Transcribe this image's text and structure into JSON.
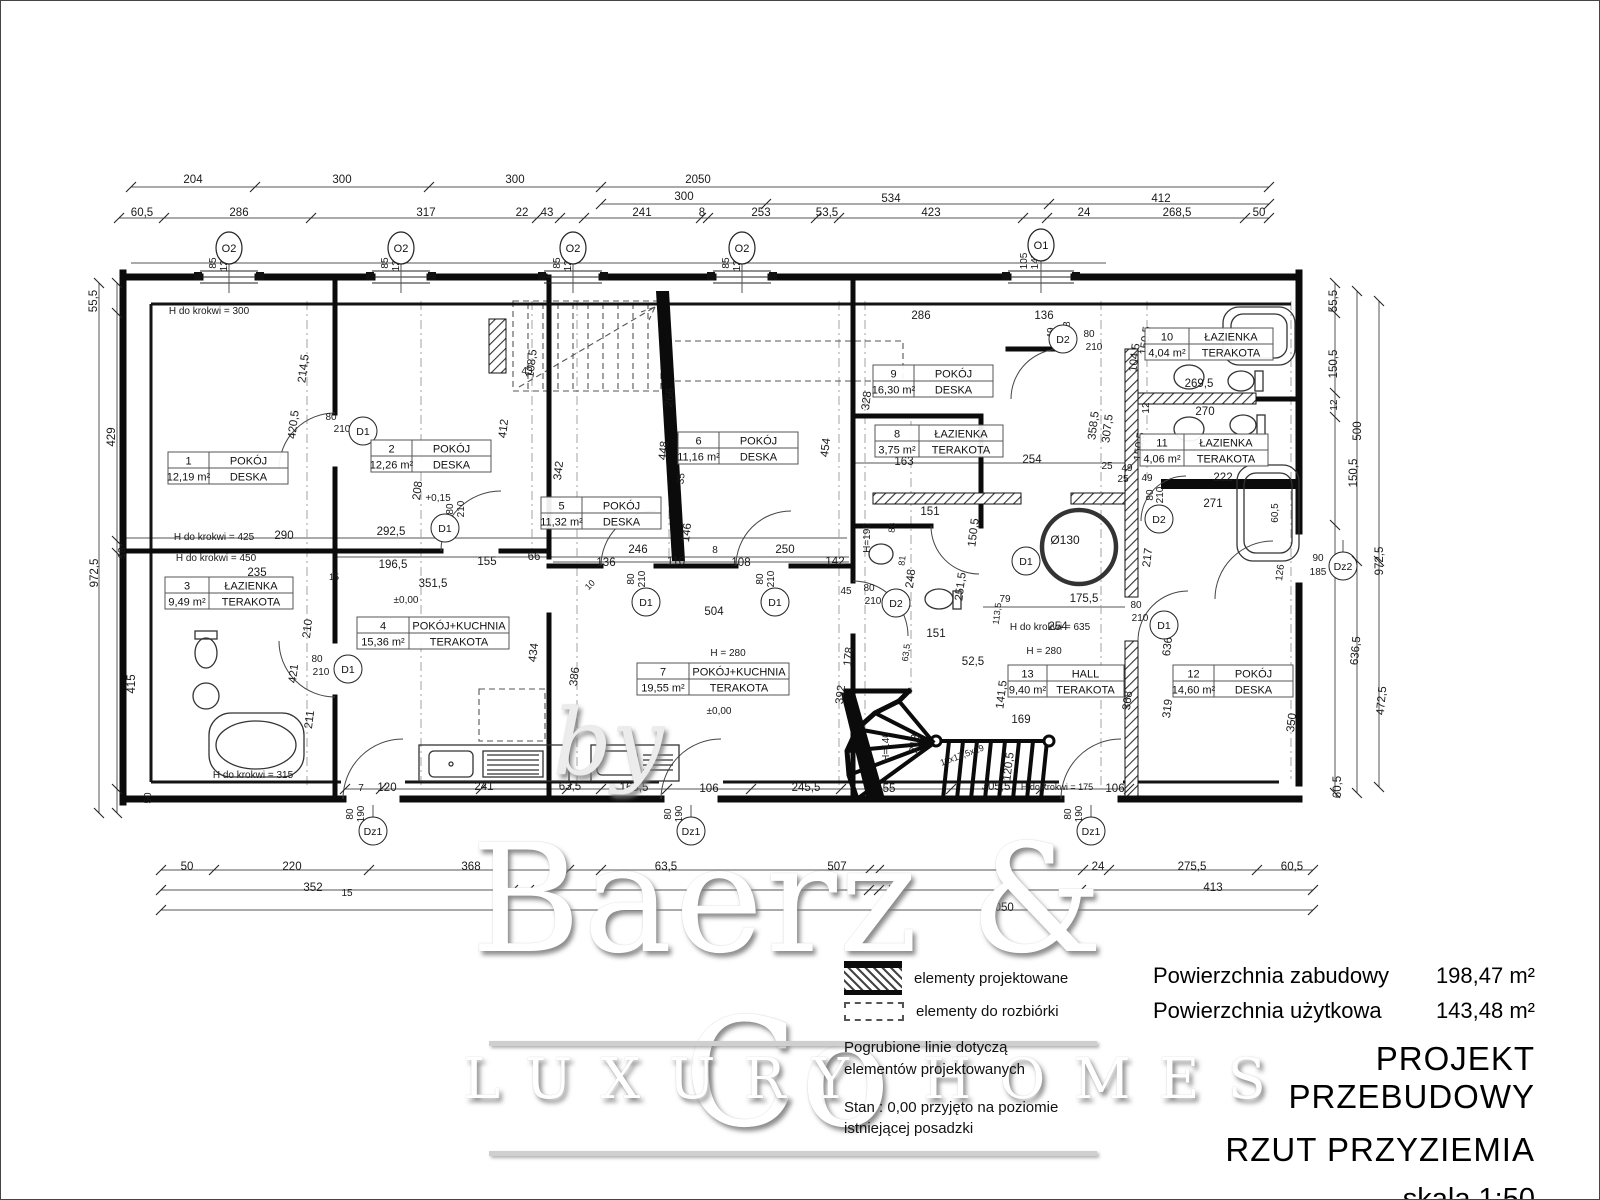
{
  "watermark": {
    "by": "by",
    "brand": "Baerz & Co",
    "tagline": "LUXURY HOMES"
  },
  "legend": {
    "projected": "elementy projektowane",
    "demolition": "elementy do rozbiórki",
    "note_line1": "Pogrubione linie dotyczą",
    "note_line2": "elementów projektowanych",
    "datum_line1": "Stan : 0,00 przyjęto na poziomie",
    "datum_line2": "istniejącej posadzki"
  },
  "title_block": {
    "area_rows": [
      {
        "label": "Powierzchnia zabudowy",
        "value": "198,47 m²"
      },
      {
        "label": "Powierzchnia użytkowa",
        "value": "143,48 m²"
      }
    ],
    "title": "PROJEKT PRZEBUDOWY",
    "subtitle": "RZUT PRZYZIEMIA",
    "scale": "skala 1:50"
  },
  "plan": {
    "rooms": [
      {
        "no": "1",
        "name": "POKÓJ",
        "area": "12,19 m²",
        "floor": "DESKA",
        "x": 227,
        "y": 467,
        "w": 120
      },
      {
        "no": "2",
        "name": "POKÓJ",
        "area": "12,26 m²",
        "floor": "DESKA",
        "x": 430,
        "y": 455,
        "w": 120
      },
      {
        "no": "3",
        "name": "ŁAZIENKA",
        "area": "9,49 m²",
        "floor": "TERAKOTA",
        "x": 228,
        "y": 592,
        "w": 128
      },
      {
        "no": "4",
        "name": "POKÓJ+KUCHNIA",
        "area": "15,36 m²",
        "floor": "TERAKOTA",
        "x": 432,
        "y": 632,
        "w": 152
      },
      {
        "no": "5",
        "name": "POKÓJ",
        "area": "11,32 m²",
        "floor": "DESKA",
        "x": 600,
        "y": 512,
        "w": 120
      },
      {
        "no": "6",
        "name": "POKÓJ",
        "area": "11,16 m²",
        "floor": "DESKA",
        "x": 737,
        "y": 447,
        "w": 120
      },
      {
        "no": "7",
        "name": "POKÓJ+KUCHNIA",
        "area": "19,55 m²",
        "floor": "TERAKOTA",
        "x": 712,
        "y": 678,
        "w": 152
      },
      {
        "no": "8",
        "name": "ŁAZIENKA",
        "area": "3,75 m²",
        "floor": "TERAKOTA",
        "x": 938,
        "y": 440,
        "w": 128
      },
      {
        "no": "9",
        "name": "POKÓJ",
        "area": "16,30 m²",
        "floor": "DESKA",
        "x": 932,
        "y": 380,
        "w": 120
      },
      {
        "no": "10",
        "name": "ŁAZIENKA",
        "area": "4,04 m²",
        "floor": "TERAKOTA",
        "x": 1208,
        "y": 343,
        "w": 128
      },
      {
        "no": "11",
        "name": "ŁAZIENKA",
        "area": "4,06 m²",
        "floor": "TERAKOTA",
        "x": 1203,
        "y": 449,
        "w": 128
      },
      {
        "no": "12",
        "name": "POKÓJ",
        "area": "14,60 m²",
        "floor": "DESKA",
        "x": 1232,
        "y": 680,
        "w": 120
      },
      {
        "no": "13",
        "name": "HALL",
        "area": "9,40 m²",
        "floor": "TERAKOTA",
        "x": 1065,
        "y": 680,
        "w": 116
      }
    ],
    "markers": [
      {
        "t": "O2",
        "x": 228,
        "y": 247,
        "k": "w",
        "hw": 29
      },
      {
        "t": "O2",
        "x": 400,
        "y": 247,
        "k": "w",
        "hw": 29
      },
      {
        "t": "O2",
        "x": 572,
        "y": 247,
        "k": "w",
        "hw": 29
      },
      {
        "t": "O2",
        "x": 741,
        "y": 247,
        "k": "w",
        "hw": 29
      },
      {
        "t": "O1",
        "x": 1040,
        "y": 244,
        "k": "w",
        "hw": 33
      },
      {
        "t": "D1",
        "x": 362,
        "y": 430,
        "k": "d"
      },
      {
        "t": "D1",
        "x": 444,
        "y": 527,
        "k": "d"
      },
      {
        "t": "D1",
        "x": 347,
        "y": 668,
        "k": "d"
      },
      {
        "t": "D1",
        "x": 645,
        "y": 601,
        "k": "d"
      },
      {
        "t": "D1",
        "x": 774,
        "y": 601,
        "k": "d"
      },
      {
        "t": "D1",
        "x": 1025,
        "y": 560,
        "k": "d"
      },
      {
        "t": "D1",
        "x": 1163,
        "y": 624,
        "k": "d"
      },
      {
        "t": "D2",
        "x": 1062,
        "y": 338,
        "k": "d"
      },
      {
        "t": "D2",
        "x": 895,
        "y": 602,
        "k": "d"
      },
      {
        "t": "D2",
        "x": 1158,
        "y": 518,
        "k": "d"
      },
      {
        "t": "Dz1",
        "x": 372,
        "y": 830,
        "k": "z"
      },
      {
        "t": "Dz1",
        "x": 690,
        "y": 830,
        "k": "z"
      },
      {
        "t": "Dz1",
        "x": 1090,
        "y": 830,
        "k": "z"
      },
      {
        "t": "Dz2",
        "x": 1342,
        "y": 565,
        "k": "z"
      }
    ],
    "annotations": [
      [
        "204",
        192,
        182
      ],
      [
        "300",
        341,
        182
      ],
      [
        "300",
        514,
        182
      ],
      [
        "2050",
        697,
        182
      ],
      [
        "300",
        683,
        199
      ],
      [
        "534",
        890,
        201
      ],
      [
        "412",
        1160,
        201
      ],
      [
        "60,5",
        141,
        215
      ],
      [
        "286",
        238,
        215
      ],
      [
        "317",
        425,
        215
      ],
      [
        "22",
        521,
        215
      ],
      [
        "43",
        546,
        215
      ],
      [
        "241",
        641,
        215
      ],
      [
        "8",
        701,
        215
      ],
      [
        "253",
        760,
        215
      ],
      [
        "53,5",
        826,
        215
      ],
      [
        "423",
        930,
        215
      ],
      [
        "24",
        1083,
        215
      ],
      [
        "268,5",
        1176,
        215
      ],
      [
        "50",
        1258,
        215
      ],
      [
        "85",
        215,
        262,
        -90,
        10
      ],
      [
        "120",
        226,
        262,
        -90,
        10
      ],
      [
        "85",
        387,
        262,
        -90,
        10
      ],
      [
        "120",
        398,
        262,
        -90,
        10
      ],
      [
        "85",
        559,
        262,
        -90,
        10
      ],
      [
        "120",
        570,
        262,
        -90,
        10
      ],
      [
        "85",
        728,
        262,
        -90,
        10
      ],
      [
        "120",
        739,
        262,
        -90,
        10
      ],
      [
        "105",
        1026,
        260,
        -90,
        10
      ],
      [
        "145",
        1037,
        260,
        -90,
        10
      ],
      [
        "55,5",
        96,
        300,
        -90
      ],
      [
        "429",
        114,
        436,
        -90
      ],
      [
        "972,5",
        97,
        572,
        -90
      ],
      [
        "18",
        124,
        552,
        -90,
        10
      ],
      [
        "415",
        134,
        683,
        -90
      ],
      [
        "50",
        150,
        797,
        -90,
        10
      ],
      [
        "55,5",
        1336,
        300,
        -90
      ],
      [
        "150,5",
        1336,
        363,
        -90
      ],
      [
        "12",
        1336,
        404,
        -90,
        10
      ],
      [
        "500",
        1360,
        430,
        -90
      ],
      [
        "150,5",
        1356,
        472,
        -90
      ],
      [
        "972,5",
        1382,
        560,
        -90
      ],
      [
        "636,5",
        1358,
        650,
        -85
      ],
      [
        "472,5",
        1384,
        700,
        -85
      ],
      [
        "60,5",
        1340,
        786,
        -90
      ],
      [
        "350",
        1294,
        722,
        -83
      ],
      [
        "60,5",
        1277,
        512,
        -90,
        10
      ],
      [
        "126",
        1282,
        572,
        -83,
        10
      ],
      [
        "90",
        1317,
        560,
        0,
        10
      ],
      [
        "185",
        1317,
        574,
        0,
        10
      ],
      [
        "50",
        186,
        869
      ],
      [
        "220",
        291,
        869
      ],
      [
        "368",
        470,
        869
      ],
      [
        "63,5",
        665,
        869
      ],
      [
        "507",
        836,
        869
      ],
      [
        "24",
        1097,
        869
      ],
      [
        "275,5",
        1191,
        869
      ],
      [
        "60,5",
        1291,
        869
      ],
      [
        "352",
        312,
        890
      ],
      [
        "15",
        346,
        895,
        0,
        10
      ],
      [
        "5",
        890,
        891,
        0,
        10
      ],
      [
        "413",
        1212,
        890
      ],
      [
        "2050",
        1000,
        910
      ],
      [
        "80",
        352,
        813,
        -90,
        10
      ],
      [
        "190",
        363,
        813,
        -90,
        10
      ],
      [
        "80",
        670,
        813,
        -90,
        10
      ],
      [
        "190",
        681,
        813,
        -90,
        10
      ],
      [
        "80",
        1070,
        813,
        -90,
        10
      ],
      [
        "190",
        1081,
        813,
        -90,
        10
      ],
      [
        "H do krokwi = 300",
        208,
        313,
        0,
        10
      ],
      [
        "214,5",
        306,
        368,
        -83
      ],
      [
        "420,5",
        296,
        424,
        -83
      ],
      [
        "208",
        420,
        490,
        -83
      ],
      [
        "80",
        330,
        419,
        0,
        10
      ],
      [
        "210",
        341,
        431,
        0,
        10
      ],
      [
        "290",
        283,
        538
      ],
      [
        "292,5",
        390,
        534
      ],
      [
        "H do krokwi = 425",
        213,
        539,
        0,
        10
      ],
      [
        "H do krokwi = 450",
        215,
        560,
        0,
        10
      ],
      [
        "235",
        256,
        575
      ],
      [
        "15",
        333,
        579,
        0,
        9
      ],
      [
        "196,5",
        392,
        567
      ],
      [
        "155",
        486,
        564
      ],
      [
        "66",
        533,
        559
      ],
      [
        "351,5",
        432,
        586
      ],
      [
        "+0,15",
        437,
        500,
        0,
        10
      ],
      [
        "±0,00",
        405,
        602,
        0,
        10
      ],
      [
        "80",
        452,
        508,
        -90,
        10
      ],
      [
        "210",
        463,
        508,
        -90,
        10
      ],
      [
        "210",
        310,
        628,
        -83
      ],
      [
        "421",
        296,
        673,
        -83
      ],
      [
        "211",
        312,
        719,
        -83
      ],
      [
        "80",
        316,
        661,
        0,
        10
      ],
      [
        "210",
        320,
        674,
        0,
        10
      ],
      [
        "H do krokwi = 315",
        252,
        777,
        0,
        10
      ],
      [
        "434",
        536,
        652,
        -83
      ],
      [
        "386",
        577,
        676,
        -83
      ],
      [
        "342",
        561,
        470,
        -83
      ],
      [
        "412",
        506,
        428,
        -83
      ],
      [
        "7",
        360,
        790,
        0,
        10
      ],
      [
        "120",
        386,
        790
      ],
      [
        "241",
        483,
        789
      ],
      [
        "63,5",
        569,
        789
      ],
      [
        "165,5",
        633,
        790
      ],
      [
        "106",
        708,
        791
      ],
      [
        "245,5",
        805,
        790
      ],
      [
        "55",
        888,
        791
      ],
      [
        "305,5",
        995,
        789
      ],
      [
        "H do krokwi = 175",
        1056,
        789,
        0,
        9
      ],
      [
        "106",
        1114,
        791
      ],
      [
        "108,5",
        534,
        363,
        -83
      ],
      [
        "43",
        526,
        373,
        0,
        10
      ],
      [
        "266",
        672,
        397,
        -83
      ],
      [
        "448",
        666,
        450,
        -83
      ],
      [
        "35",
        683,
        478,
        -83,
        10
      ],
      [
        "146",
        689,
        532,
        -83
      ],
      [
        "246",
        637,
        552
      ],
      [
        "136",
        605,
        565
      ],
      [
        "110",
        675,
        564
      ],
      [
        "8",
        714,
        552,
        0,
        10
      ],
      [
        "108",
        740,
        565
      ],
      [
        "250",
        784,
        552
      ],
      [
        "142",
        834,
        564
      ],
      [
        "10",
        591,
        586,
        -45,
        9
      ],
      [
        "80",
        633,
        578,
        -90,
        10
      ],
      [
        "210",
        644,
        578,
        -90,
        10
      ],
      [
        "80",
        762,
        578,
        -90,
        10
      ],
      [
        "210",
        773,
        578,
        -90,
        10
      ],
      [
        "504",
        713,
        614
      ],
      [
        "H = 280",
        727,
        655,
        0,
        10
      ],
      [
        "45",
        845,
        593,
        0,
        10
      ],
      [
        "80",
        868,
        590,
        0,
        10
      ],
      [
        "210",
        872,
        603,
        0,
        10
      ],
      [
        "178",
        851,
        656,
        -83
      ],
      [
        "392",
        843,
        694,
        -83
      ],
      [
        "328",
        869,
        400,
        -83
      ],
      [
        "454",
        828,
        447,
        -83
      ],
      [
        "±0,00",
        718,
        713,
        0,
        10
      ],
      [
        "286",
        920,
        318
      ],
      [
        "136",
        1043,
        318
      ],
      [
        "49",
        1053,
        332,
        -90,
        10
      ],
      [
        "48",
        1069,
        326,
        -90,
        10
      ],
      [
        "80",
        1088,
        336,
        0,
        10
      ],
      [
        "210",
        1093,
        349,
        0,
        10
      ],
      [
        "104,5",
        1137,
        357,
        -83
      ],
      [
        "150,5",
        1148,
        340,
        -83
      ],
      [
        "163",
        903,
        464
      ],
      [
        "417",
        941,
        455
      ],
      [
        "254",
        1031,
        462
      ],
      [
        "25",
        1106,
        468,
        0,
        10
      ],
      [
        "49",
        1126,
        470,
        0,
        10
      ],
      [
        "151",
        929,
        514
      ],
      [
        "86",
        894,
        527,
        -83,
        9
      ],
      [
        "81",
        904,
        560,
        -83,
        9
      ],
      [
        "248",
        913,
        578,
        -83
      ],
      [
        "251,5",
        963,
        586,
        -83
      ],
      [
        "150,5",
        976,
        532,
        -83
      ],
      [
        "H=190",
        869,
        537,
        -90,
        10
      ],
      [
        "79",
        1004,
        601,
        0,
        10
      ],
      [
        "175,5",
        1083,
        601
      ],
      [
        "254",
        1057,
        629
      ],
      [
        "52,5",
        972,
        664
      ],
      [
        "141,5",
        1004,
        694,
        -83
      ],
      [
        "113,5",
        999,
        613,
        -83,
        9
      ],
      [
        "80",
        1135,
        607,
        0,
        10
      ],
      [
        "210",
        1139,
        620,
        0,
        10
      ],
      [
        "H do krokwi = 635",
        1049,
        629,
        0,
        10
      ],
      [
        "H = 280",
        1043,
        653,
        0,
        10
      ],
      [
        "169",
        1020,
        722
      ],
      [
        "213",
        917,
        743,
        -83
      ],
      [
        "H=140",
        888,
        746,
        -90,
        10
      ],
      [
        "120,5",
        1011,
        766,
        -83
      ],
      [
        "11x17,5x29",
        962,
        757,
        -20,
        9
      ],
      [
        "368",
        1130,
        700,
        -83
      ],
      [
        "319",
        1170,
        708,
        -83
      ],
      [
        "636",
        1170,
        646,
        -83
      ],
      [
        "217",
        1150,
        557,
        -83
      ],
      [
        "358,5",
        1096,
        425,
        -83
      ],
      [
        "307,5",
        1110,
        428,
        -83
      ],
      [
        "151",
        935,
        636
      ],
      [
        "63,5",
        908,
        652,
        -83,
        9
      ],
      [
        "269,5",
        1198,
        386
      ],
      [
        "12",
        1148,
        407,
        -90,
        10
      ],
      [
        "270",
        1204,
        414
      ],
      [
        "150,5",
        1142,
        446,
        -83
      ],
      [
        "25",
        1122,
        481,
        0,
        10
      ],
      [
        "49",
        1146,
        480,
        0,
        10
      ],
      [
        "80",
        1152,
        494,
        -90,
        10
      ],
      [
        "210",
        1162,
        494,
        -90,
        10
      ],
      [
        "222",
        1222,
        480
      ],
      [
        "271",
        1212,
        506
      ],
      [
        "Ø130",
        1064,
        543,
        0,
        12
      ]
    ]
  }
}
